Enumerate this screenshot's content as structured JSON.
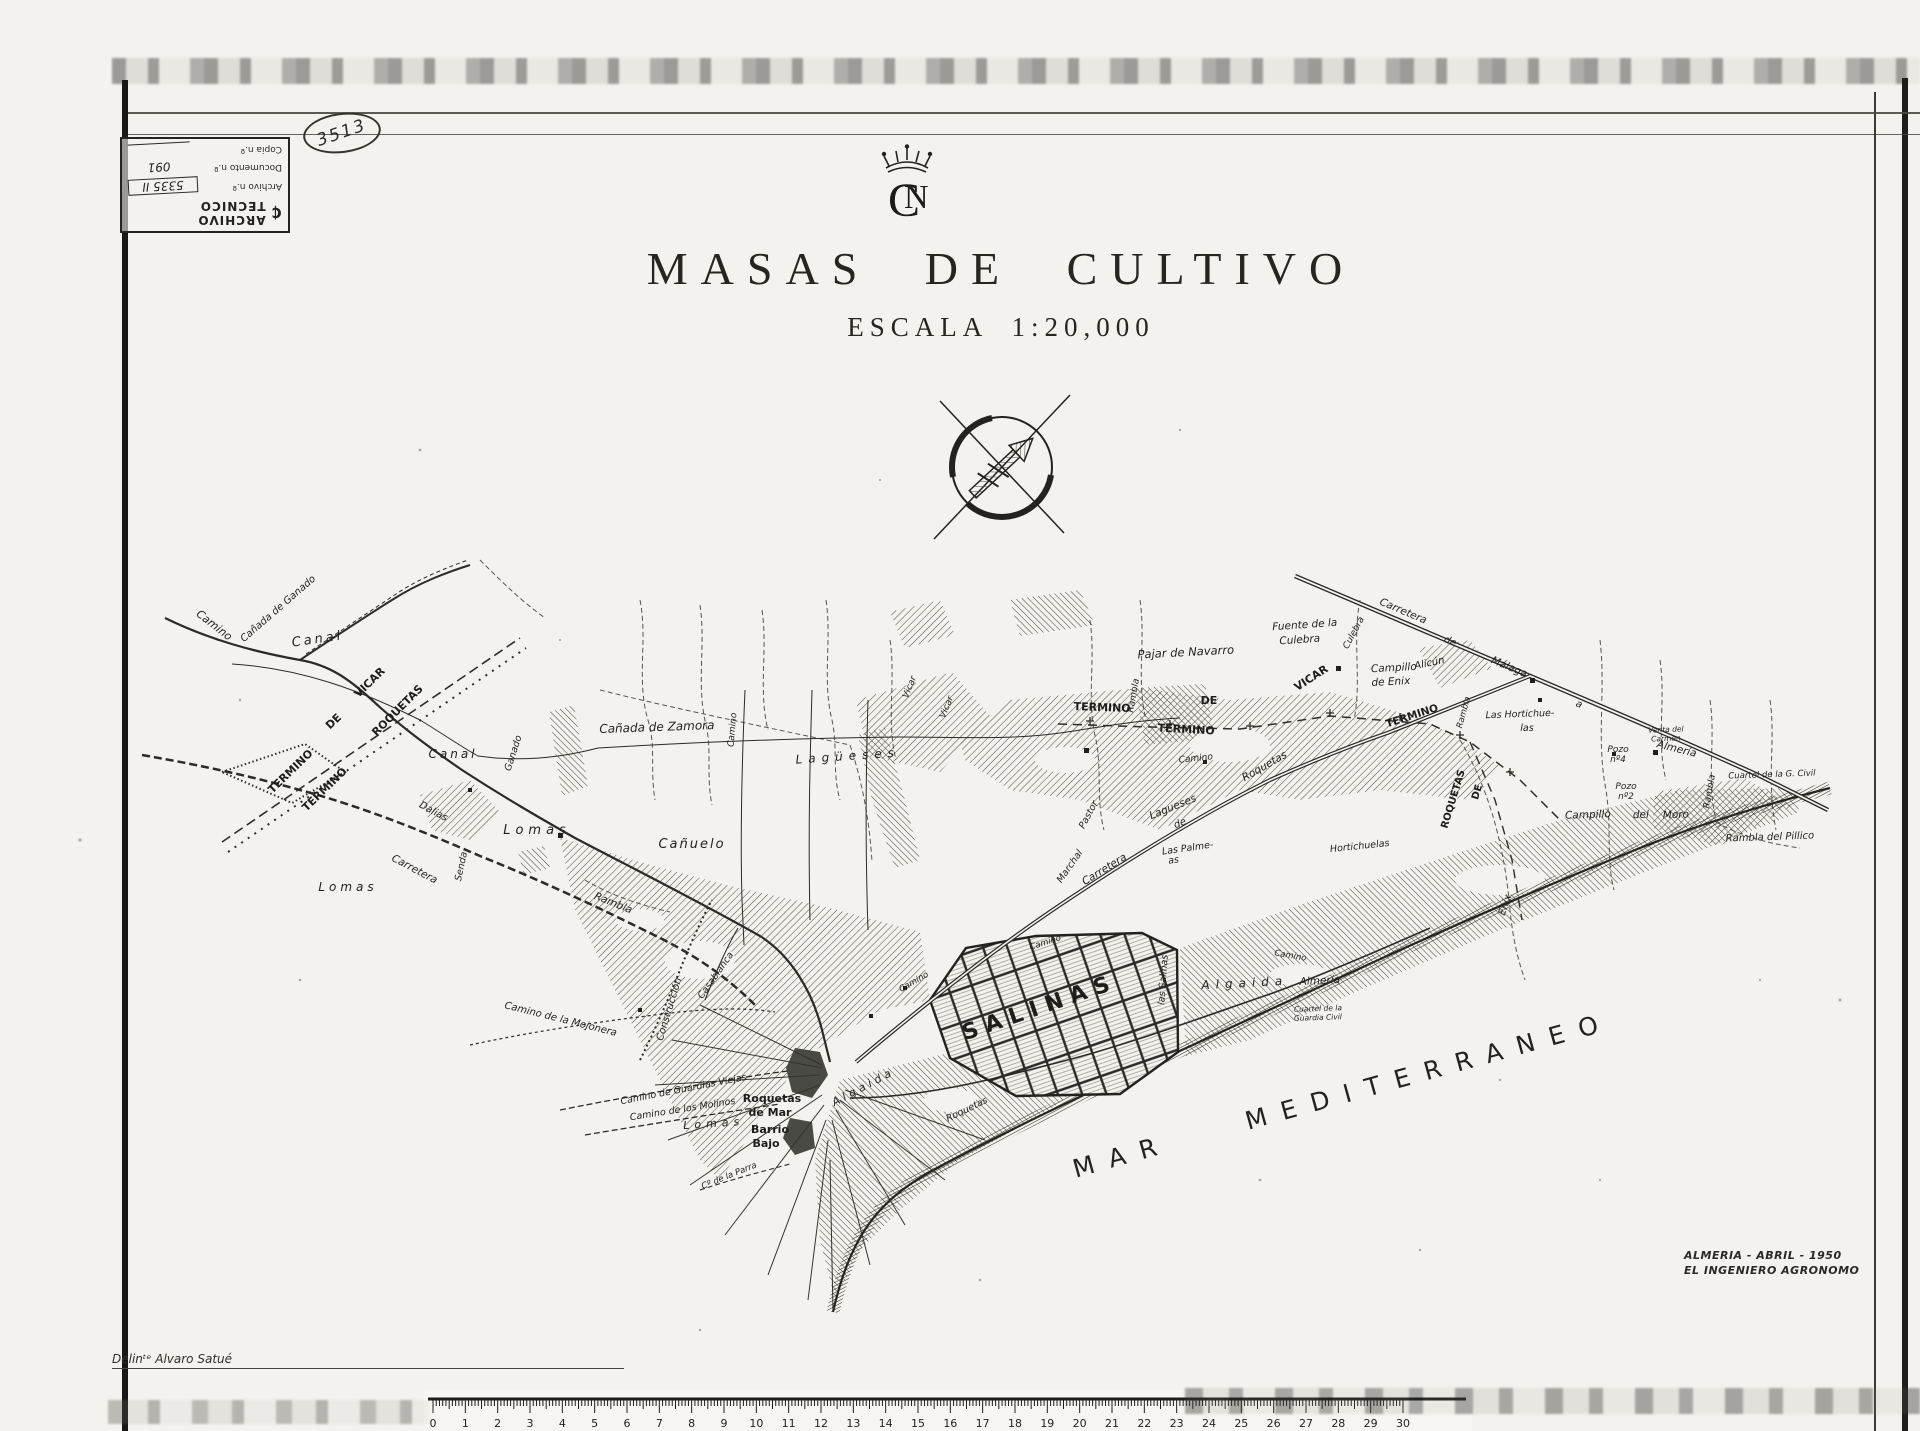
{
  "document": {
    "stamp": {
      "title": "ARCHIVO TECNICO",
      "logo_glyph": "₵",
      "rows": [
        {
          "label": "Archivo n.º",
          "value": "5335 II"
        },
        {
          "label": "Documento n.º",
          "value": "091"
        },
        {
          "label": "Copia n.º",
          "value": ""
        }
      ]
    },
    "handwritten_number": "3513",
    "emblem_c": "C",
    "emblem_n": "N",
    "title": "MASAS DE CULTIVO",
    "subtitle": "ESCALA 1:20,000",
    "credit_line1": "ALMERIA - ABRIL - 1950",
    "credit_line2": "EL INGENIERO AGRONOMO",
    "delineator": "Delinᵗᵉ Alvaro Satué"
  },
  "map": {
    "sea_label": "MAR MEDITERRANEO",
    "labels": [
      {
        "t": "Camino",
        "x": 212,
        "y": 628,
        "r": 38,
        "s": 11
      },
      {
        "t": "Cañada de Ganado",
        "x": 280,
        "y": 611,
        "r": -41,
        "s": 10
      },
      {
        "t": "Canal",
        "x": 318,
        "y": 643,
        "r": -8,
        "s": 13,
        "sp": 3
      },
      {
        "t": "VICAR",
        "x": 372,
        "y": 685,
        "r": -44,
        "s": 11,
        "c": "cap"
      },
      {
        "t": "DE",
        "x": 336,
        "y": 724,
        "r": -44,
        "s": 11,
        "c": "cap"
      },
      {
        "t": "ROQUETAS",
        "x": 400,
        "y": 713,
        "r": -45,
        "s": 11,
        "c": "cap"
      },
      {
        "t": "TERMINO",
        "x": 293,
        "y": 774,
        "r": -44,
        "s": 11,
        "c": "cap"
      },
      {
        "t": "TERMINO",
        "x": 327,
        "y": 792,
        "r": -44,
        "s": 11,
        "c": "cap"
      },
      {
        "t": "Canal",
        "x": 453,
        "y": 758,
        "r": 0,
        "s": 12,
        "sp": 3
      },
      {
        "t": "Ganado",
        "x": 516,
        "y": 754,
        "r": -72,
        "s": 9.5
      },
      {
        "t": "Cañada de Zamora",
        "x": 657,
        "y": 731,
        "r": -2,
        "s": 12
      },
      {
        "t": "Lomas",
        "x": 537,
        "y": 834,
        "r": 0,
        "s": 13,
        "sp": 5
      },
      {
        "t": "Cañuelo",
        "x": 692,
        "y": 848,
        "r": 0,
        "s": 13,
        "sp": 2
      },
      {
        "t": "Dalias",
        "x": 432,
        "y": 814,
        "r": 28,
        "s": 10
      },
      {
        "t": "Carretera",
        "x": 413,
        "y": 872,
        "r": 28,
        "s": 10.5
      },
      {
        "t": "Senda",
        "x": 464,
        "y": 867,
        "r": -78,
        "s": 9.5
      },
      {
        "t": "Rambla",
        "x": 612,
        "y": 906,
        "r": 22,
        "s": 10.5
      },
      {
        "t": "Lomas",
        "x": 348,
        "y": 891,
        "r": 0,
        "s": 12,
        "sp": 4
      },
      {
        "t": "Lagüeses",
        "x": 848,
        "y": 760,
        "r": -4,
        "s": 12,
        "sp": 6
      },
      {
        "t": "Lagueses",
        "x": 1174,
        "y": 810,
        "r": -22,
        "s": 10.5
      },
      {
        "t": "de",
        "x": 1181,
        "y": 826,
        "r": -22,
        "s": 10
      },
      {
        "t": "Pajar de Navarro",
        "x": 1186,
        "y": 656,
        "r": -3,
        "s": 11.5
      },
      {
        "t": "Fuente de la",
        "x": 1305,
        "y": 628,
        "r": -4,
        "s": 10.5
      },
      {
        "t": "Culebra",
        "x": 1300,
        "y": 643,
        "r": -4,
        "s": 10.5
      },
      {
        "t": "TERMINO",
        "x": 1102,
        "y": 711,
        "r": 2,
        "s": 11,
        "c": "cap"
      },
      {
        "t": "DE",
        "x": 1209,
        "y": 704,
        "r": 0,
        "s": 11,
        "c": "cap"
      },
      {
        "t": "TERMINO",
        "x": 1186,
        "y": 733,
        "r": 3,
        "s": 11,
        "c": "cap"
      },
      {
        "t": "VICAR",
        "x": 1313,
        "y": 681,
        "r": -33,
        "s": 11,
        "c": "cap"
      },
      {
        "t": "Campillo",
        "x": 1394,
        "y": 671,
        "r": -3,
        "s": 10.5
      },
      {
        "t": "de Enix",
        "x": 1391,
        "y": 685,
        "r": -3,
        "s": 10.5
      },
      {
        "t": "Alicún",
        "x": 1430,
        "y": 666,
        "r": -12,
        "s": 10
      },
      {
        "t": "Carretera",
        "x": 1402,
        "y": 614,
        "r": 23,
        "s": 10.5
      },
      {
        "t": "de",
        "x": 1449,
        "y": 644,
        "r": 23,
        "s": 10
      },
      {
        "t": "Málaga",
        "x": 1508,
        "y": 670,
        "r": 23,
        "s": 10.5
      },
      {
        "t": "a",
        "x": 1578,
        "y": 707,
        "r": 23,
        "s": 10
      },
      {
        "t": "Almería",
        "x": 1676,
        "y": 752,
        "r": 14,
        "s": 10.5
      },
      {
        "t": "Las Hortichue-",
        "x": 1520,
        "y": 717,
        "r": -2,
        "s": 9.5
      },
      {
        "t": "las",
        "x": 1527,
        "y": 731,
        "r": 0,
        "s": 9.5
      },
      {
        "t": "Venta del",
        "x": 1666,
        "y": 732,
        "r": -2,
        "s": 7.5
      },
      {
        "t": "Carmen",
        "x": 1666,
        "y": 741,
        "r": -2,
        "s": 7.5
      },
      {
        "t": "Pozo",
        "x": 1618,
        "y": 752,
        "r": 0,
        "s": 9
      },
      {
        "t": "nº4",
        "x": 1618,
        "y": 762,
        "r": 0,
        "s": 9
      },
      {
        "t": "Pozo",
        "x": 1626,
        "y": 789,
        "r": 0,
        "s": 9
      },
      {
        "t": "nº2",
        "x": 1626,
        "y": 799,
        "r": 0,
        "s": 9
      },
      {
        "t": "Cuartel de la G. Civil",
        "x": 1772,
        "y": 777,
        "r": -2,
        "s": 8.5
      },
      {
        "t": "Campillo",
        "x": 1588,
        "y": 818,
        "r": -2,
        "s": 10.5
      },
      {
        "t": "del",
        "x": 1641,
        "y": 818,
        "r": -2,
        "s": 10.5
      },
      {
        "t": "Moro",
        "x": 1676,
        "y": 818,
        "r": -2,
        "s": 10.5
      },
      {
        "t": "Rambla del Pillico",
        "x": 1770,
        "y": 840,
        "r": -2,
        "s": 10
      },
      {
        "t": "ROQUETAS",
        "x": 1456,
        "y": 800,
        "r": -73,
        "s": 10,
        "c": "cap"
      },
      {
        "t": "DE",
        "x": 1480,
        "y": 793,
        "r": -73,
        "s": 10,
        "c": "cap"
      },
      {
        "t": "TERMINO",
        "x": 1413,
        "y": 719,
        "r": -18,
        "s": 10.5,
        "c": "cap"
      },
      {
        "t": "Enix",
        "x": 1508,
        "y": 906,
        "r": -70,
        "s": 10
      },
      {
        "t": "Roquetas",
        "x": 1266,
        "y": 769,
        "r": -30,
        "s": 10.5
      },
      {
        "t": "Camino",
        "x": 1196,
        "y": 761,
        "r": -6,
        "s": 9
      },
      {
        "t": "Marchal",
        "x": 1072,
        "y": 868,
        "r": -55,
        "s": 9.5
      },
      {
        "t": "Carretera",
        "x": 1106,
        "y": 872,
        "r": -32,
        "s": 10.5
      },
      {
        "t": "Las Palme-",
        "x": 1188,
        "y": 851,
        "r": -8,
        "s": 9.5
      },
      {
        "t": "as",
        "x": 1174,
        "y": 863,
        "r": -8,
        "s": 9.5
      },
      {
        "t": "Hortichuelas",
        "x": 1360,
        "y": 849,
        "r": -6,
        "s": 9.5
      },
      {
        "t": "Pastor",
        "x": 1091,
        "y": 816,
        "r": -62,
        "s": 9.5
      },
      {
        "t": "Rambla",
        "x": 1136,
        "y": 696,
        "r": -80,
        "s": 9
      },
      {
        "t": "Vicar",
        "x": 912,
        "y": 688,
        "r": -68,
        "s": 9
      },
      {
        "t": "Vicar",
        "x": 949,
        "y": 708,
        "r": -68,
        "s": 9
      },
      {
        "t": "Culebra",
        "x": 1356,
        "y": 634,
        "r": -62,
        "s": 9
      },
      {
        "t": "Rambla",
        "x": 1712,
        "y": 792,
        "r": -80,
        "s": 9
      },
      {
        "t": "Rambla",
        "x": 1466,
        "y": 713,
        "r": -75,
        "s": 8.5
      },
      {
        "t": "SALINAS",
        "x": 1042,
        "y": 1014,
        "r": -19,
        "s": 22,
        "sp": 8,
        "c": "up"
      },
      {
        "t": "las Salinas",
        "x": 1166,
        "y": 980,
        "r": -86,
        "s": 9.5
      },
      {
        "t": "Algaida",
        "x": 1245,
        "y": 987,
        "r": -3,
        "s": 12,
        "sp": 6
      },
      {
        "t": "Almería",
        "x": 1320,
        "y": 984,
        "r": -3,
        "s": 10.5
      },
      {
        "t": "Cuartel de la",
        "x": 1318,
        "y": 1011,
        "r": -2,
        "s": 7.5
      },
      {
        "t": "Guardia Civil",
        "x": 1318,
        "y": 1020,
        "r": -2,
        "s": 7.5
      },
      {
        "t": "Roquetas",
        "x": 968,
        "y": 1112,
        "r": -26,
        "s": 9.5
      },
      {
        "t": "Camino",
        "x": 1046,
        "y": 945,
        "r": -18,
        "s": 8.5
      },
      {
        "t": "Camino",
        "x": 915,
        "y": 984,
        "r": -30,
        "s": 8.5
      },
      {
        "t": "Camino",
        "x": 1290,
        "y": 958,
        "r": 10,
        "s": 8.5
      },
      {
        "t": "Roquetas",
        "x": 772,
        "y": 1102,
        "r": 0,
        "s": 11,
        "c": "up"
      },
      {
        "t": "de Mar",
        "x": 770,
        "y": 1116,
        "r": 0,
        "s": 11,
        "c": "up"
      },
      {
        "t": "Barrio",
        "x": 770,
        "y": 1133,
        "r": 0,
        "s": 11,
        "c": "up"
      },
      {
        "t": "Bajo",
        "x": 766,
        "y": 1147,
        "r": 0,
        "s": 11,
        "c": "up"
      },
      {
        "t": "Camino de la Mojonera",
        "x": 560,
        "y": 1022,
        "r": 14,
        "s": 10
      },
      {
        "t": "Construcción",
        "x": 672,
        "y": 1010,
        "r": -73,
        "s": 10
      },
      {
        "t": "Casablanca",
        "x": 718,
        "y": 977,
        "r": -55,
        "s": 9.5
      },
      {
        "t": "Camino de Guardias Viejas",
        "x": 684,
        "y": 1092,
        "r": -11,
        "s": 9.5
      },
      {
        "t": "Camino de los Molinos",
        "x": 683,
        "y": 1112,
        "r": -9,
        "s": 9.5
      },
      {
        "t": "Lomas",
        "x": 714,
        "y": 1127,
        "r": -4,
        "s": 11,
        "sp": 5
      },
      {
        "t": "Cº de la Parra",
        "x": 730,
        "y": 1178,
        "r": -22,
        "s": 8.5
      },
      {
        "t": "Algaida",
        "x": 865,
        "y": 1090,
        "r": -28,
        "s": 11,
        "sp": 4
      },
      {
        "t": "Camino",
        "x": 735,
        "y": 730,
        "r": -85,
        "s": 9
      }
    ]
  },
  "ruler": {
    "numbers": [
      "0",
      "1",
      "2",
      "3",
      "4",
      "5",
      "6",
      "7",
      "8",
      "9",
      "10",
      "11",
      "12",
      "13",
      "14",
      "15",
      "16",
      "17",
      "18",
      "19",
      "20",
      "21",
      "22",
      "23",
      "24",
      "25",
      "26",
      "27",
      "28",
      "29",
      "30"
    ]
  },
  "colors": {
    "ink": "#23221e",
    "paper": "#f3f2ee",
    "town": "#4a4a45"
  }
}
